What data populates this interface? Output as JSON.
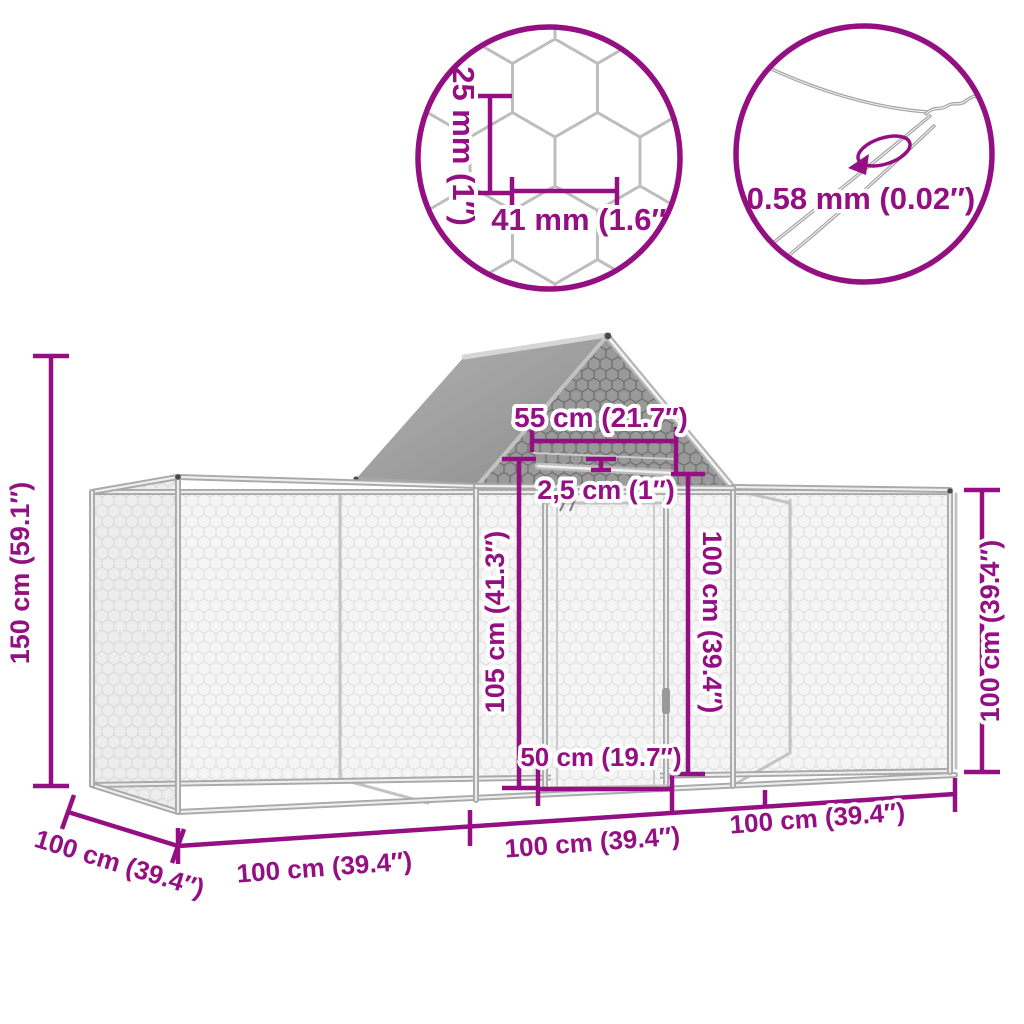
{
  "accent_color": "#930f82",
  "detail_circles": {
    "mesh_detail": {
      "cell_height_label": "25 mm (1″)",
      "cell_width_label": "41 mm (1.6″)"
    },
    "wire_detail": {
      "wire_gauge_label": "0.58 mm (0.02″)"
    }
  },
  "structure_dimensions": {
    "total_height": "150 cm (59.1″)",
    "roof_ridge_width": "55 cm (21.7″)",
    "frame_tube_diameter": "2,5 cm (1″)",
    "door_height": "105 cm (41.3″)",
    "door_opening_height": "100 cm (39.4″)",
    "door_width": "50 cm (19.7″)",
    "side_wall_height": "100 cm (39.4″)",
    "depth": "100 cm (39.4″)",
    "bottom_segments": [
      "100 cm (39.4″)",
      "100 cm (39.4″)",
      "100 cm (39.4″)"
    ]
  }
}
